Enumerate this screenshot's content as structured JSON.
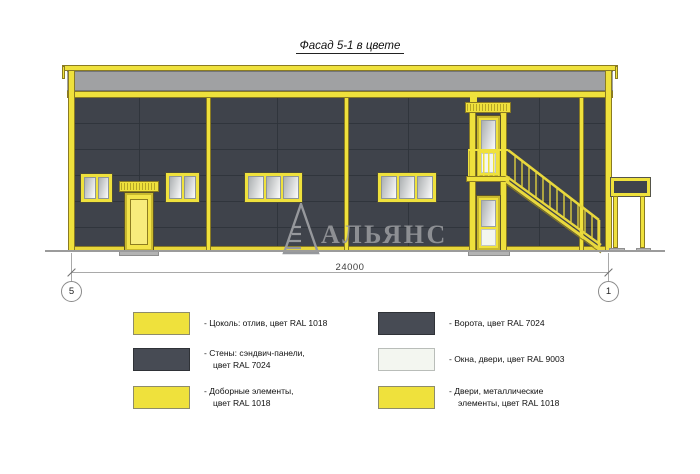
{
  "title": "Фасад 5-1 в цвете",
  "watermark": {
    "text": "АЛЬЯНС"
  },
  "dimension": {
    "value": "24000",
    "axis_left": "5",
    "axis_right": "1"
  },
  "legend": {
    "left": [
      {
        "swatch": "yellow",
        "label": "- Цоколь: отлив, цвет RAL 1018"
      },
      {
        "swatch": "dark",
        "label": "- Стены: сэндвич-панели,\nцвет RAL 7024"
      },
      {
        "swatch": "yellow",
        "label": "- Доборные элементы,\nцвет RAL 1018"
      }
    ],
    "right": [
      {
        "swatch": "dark",
        "label": "- Ворота, цвет RAL 7024"
      },
      {
        "swatch": "white",
        "label": "- Окна, двери, цвет RAL 9003"
      },
      {
        "swatch": "yellow",
        "label": "- Двери, металлические\nэлементы, цвет RAL 1018"
      }
    ]
  },
  "colors": {
    "yellow": "#EFE13C",
    "wall": "#3F434B",
    "parapet": "#A0A1A3",
    "swatch-dark": "#474B54",
    "swatch-white": "#F3F6F0",
    "glass-dark": "#ACB0B2",
    "glass-light": "#FDFDFD",
    "line": "#9B9B9B",
    "watermark": "#94969A"
  }
}
